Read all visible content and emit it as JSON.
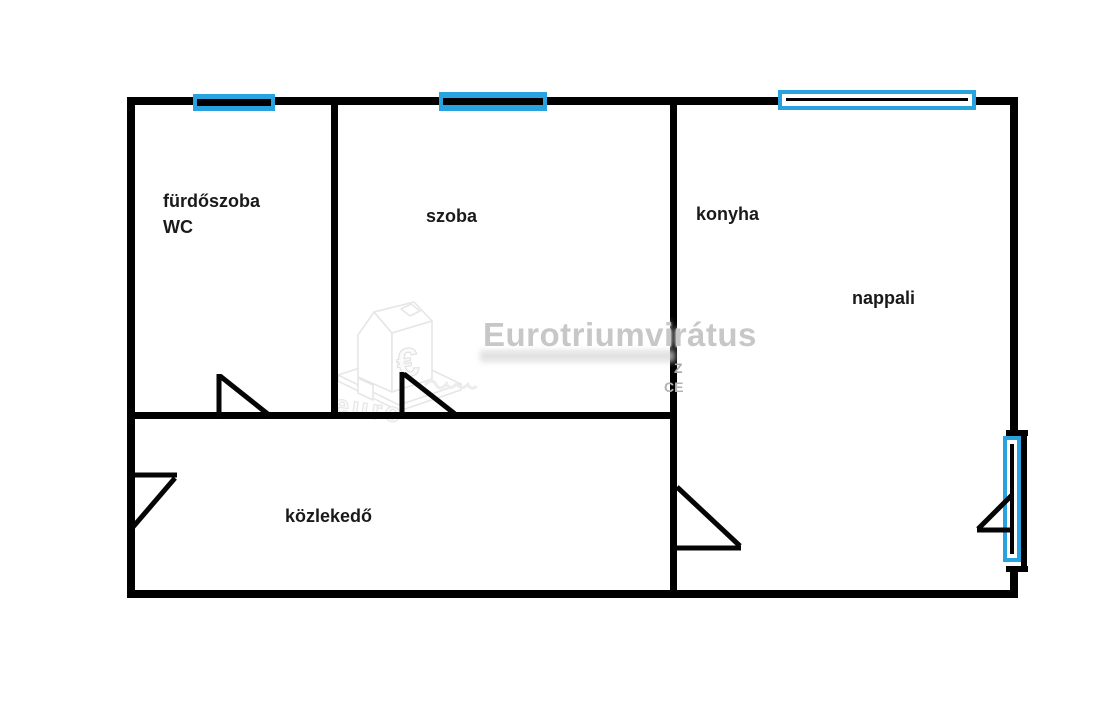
{
  "plan": {
    "rooms": {
      "bathroom": {
        "line1": "fürdőszoba",
        "line2": "WC"
      },
      "bedroom": {
        "label": "szoba"
      },
      "kitchen": {
        "label": "konyha"
      },
      "living_room": {
        "label": "nappali"
      },
      "hallway": {
        "label": "közlekedő"
      }
    }
  },
  "watermark": {
    "brand": "Eurotriumvirátus",
    "logo_symbol": "€",
    "logo_caption": "euro",
    "fragment_top": "Z",
    "fragment_bottom": "CE"
  },
  "colors": {
    "wall_black": "#000000",
    "window_blue": "#29a3e0",
    "watermark_gray": "#c7c7c7",
    "logo_gray": "#e8e8e8"
  }
}
